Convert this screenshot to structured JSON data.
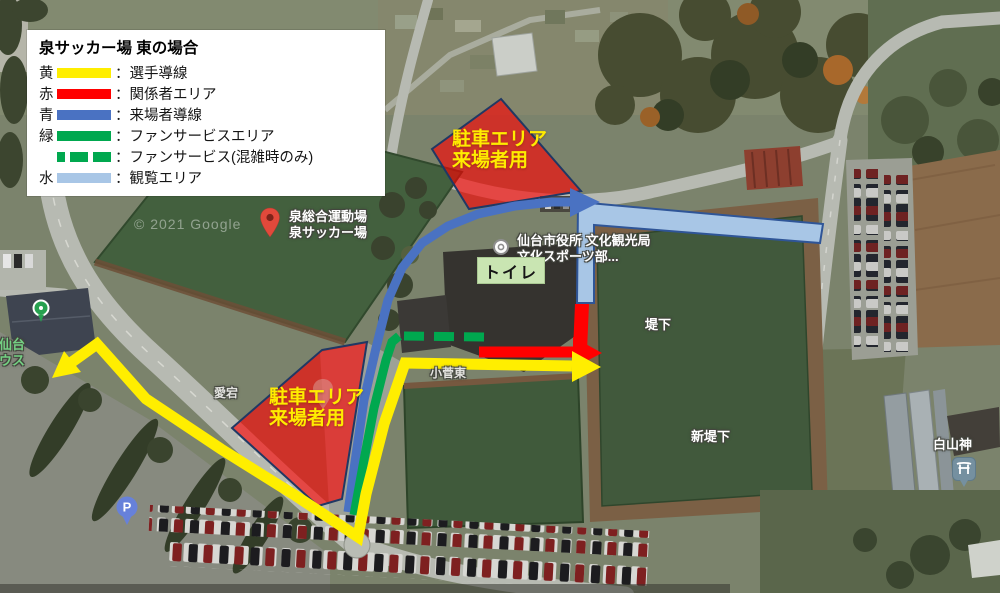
{
  "legend": {
    "title": "泉サッカー場 東の場合",
    "items": [
      {
        "key": "黄",
        "label": "：選手導線",
        "style": "solid",
        "color": "#ffee00"
      },
      {
        "key": "赤",
        "label": "：関係者エリア",
        "style": "solid",
        "color": "#ff0000"
      },
      {
        "key": "青",
        "label": "：来場者導線",
        "style": "solid",
        "color": "#4a72c2"
      },
      {
        "key": "緑",
        "label": "：ファンサービスエリア",
        "style": "solid",
        "color": "#00a84f"
      },
      {
        "key": "",
        "label": "：ファンサービス(混雑時のみ)",
        "style": "dashed",
        "color": "#00a84f"
      },
      {
        "key": "水",
        "label": "：観覧エリア",
        "style": "solid",
        "color": "#a8c6e6"
      }
    ]
  },
  "overlay_labels": {
    "parking_top": {
      "line1": "駐車エリア",
      "line2": "来場者用"
    },
    "parking_bottom": {
      "line1": "駐車エリア",
      "line2": "来場者用"
    },
    "toilet": "トイレ"
  },
  "map_labels": {
    "venue": {
      "line1": "泉総合運動場",
      "line2": "泉サッカー場"
    },
    "city_office": {
      "line1": "仙台市役所 文化観光局",
      "line2": "文化スポーツ部..."
    },
    "field_ne": "堤下",
    "field_se": "新堤下",
    "district_center": "小菅東",
    "district_west": "愛宕",
    "shrine": "白山神",
    "clubhouse": {
      "line1": "ア仙台",
      "line2": "ハウス"
    },
    "parking_pin": "P",
    "watermark": "© 2021 Google"
  }
}
